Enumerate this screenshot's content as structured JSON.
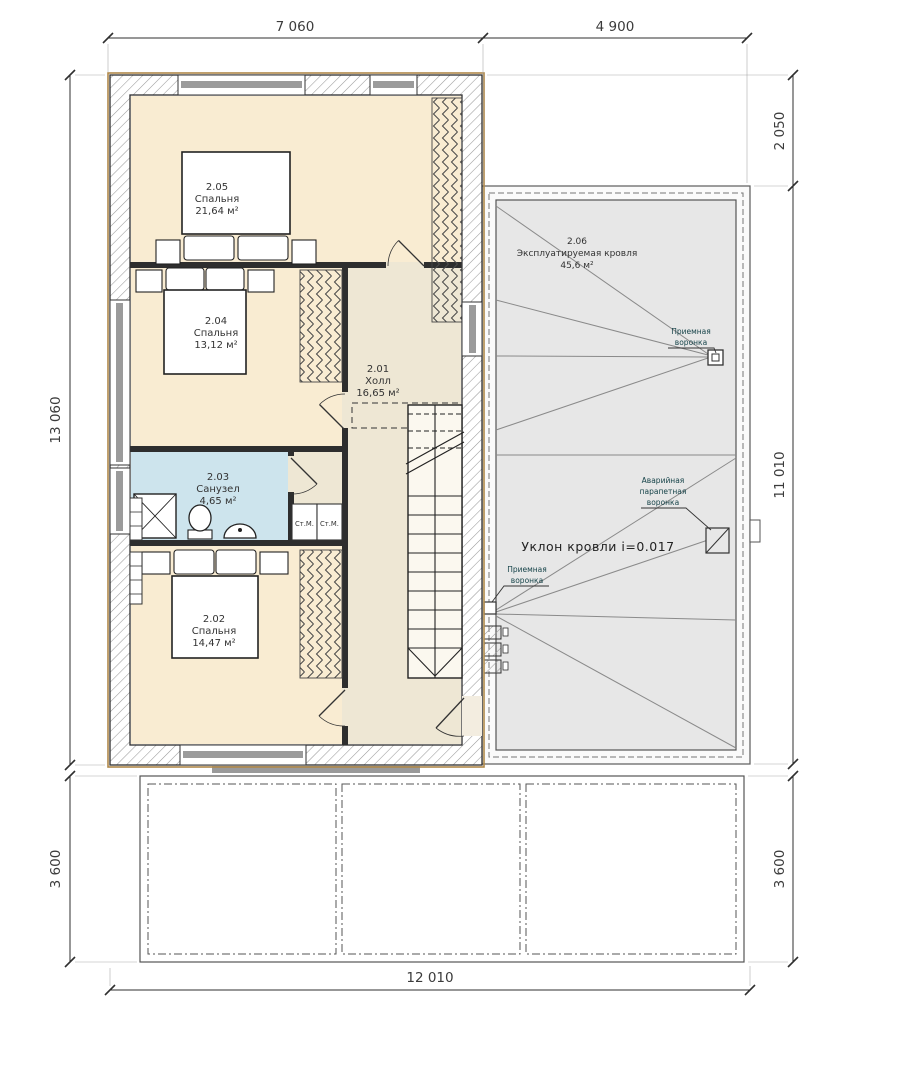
{
  "dimensions": {
    "top_left": "7 060",
    "top_right": "4 900",
    "bottom": "12 010",
    "left_main": "13 060",
    "left_lower": "3 600",
    "right_top": "2 050",
    "right_main": "11 010",
    "right_lower": "3 600"
  },
  "rooms": {
    "r205": {
      "number": "2.05",
      "name": "Спальня",
      "area": "21,64 м²"
    },
    "r204": {
      "number": "2.04",
      "name": "Спальня",
      "area": "13,12 м²"
    },
    "r201": {
      "number": "2.01",
      "name": "Холл",
      "area": "16,65 м²"
    },
    "r203": {
      "number": "2.03",
      "name": "Санузел",
      "area": "4,65 м²"
    },
    "r202": {
      "number": "2.02",
      "name": "Спальня",
      "area": "14,47 м²"
    },
    "r206": {
      "number": "2.06",
      "name": "Эксплуатируемая кровля",
      "area": "45,6 м²"
    }
  },
  "roof": {
    "slope": "Уклон кровли i=0.017",
    "drain1": {
      "line1": "Приемная",
      "line2": "воронка"
    },
    "drain2": {
      "line1": "Приемная",
      "line2": "воронка"
    },
    "emergency": {
      "line1": "Аварийная",
      "line2": "парапетная",
      "line3": "воронка"
    }
  },
  "appliances": {
    "washer1": "Ст.М.",
    "washer2": "Ст.М."
  },
  "colors": {
    "bedroom_fill": "#f9ecd2",
    "hall_fill": "#eee7d4",
    "bath_fill": "#cde4ed",
    "roof_fill": "#e7e7e7",
    "wall_outline_tan": "#b0894a"
  }
}
